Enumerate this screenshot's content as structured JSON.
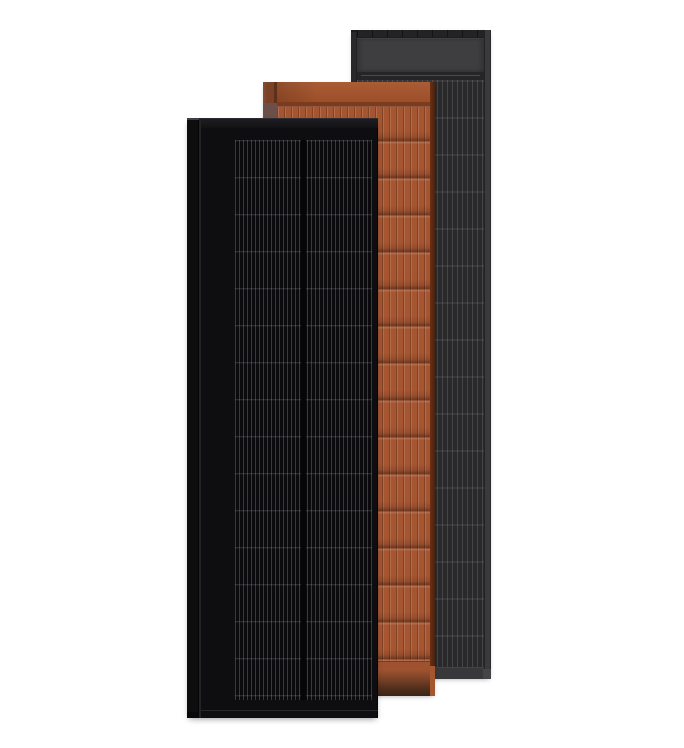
{
  "scene": {
    "background": "#ffffff",
    "subject": "three overlapping solar panel product renders",
    "panels": [
      {
        "id": "black",
        "name": "black-solar-panel",
        "stack_position": "front-left",
        "colors": {
          "frame": "#0e0e10",
          "rail": "#0d0d0e",
          "cells": "#0b0b0d"
        }
      },
      {
        "id": "terra",
        "name": "terracotta-solar-panel",
        "stack_position": "middle",
        "colors": {
          "base": "#a65531",
          "side": "#7a4126",
          "notch": "#6d4f49",
          "groove": "#7c3a1e",
          "edge": "#6b3015",
          "footerdark": "#3a2418"
        }
      },
      {
        "id": "gray",
        "name": "graphite-solar-panel",
        "stack_position": "back-right",
        "colors": {
          "frame": "#3a3a3c",
          "rail": "#29292b",
          "topstrip": "#232325",
          "header": "#3e3e40",
          "line": "#4a4a4e",
          "cells": "#29292b",
          "footer": "#38383a"
        }
      }
    ]
  }
}
